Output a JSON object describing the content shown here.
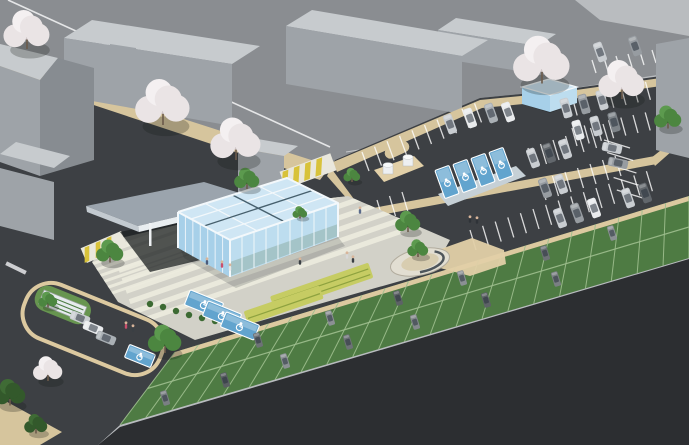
{
  "meta": {
    "subject": "Aerial axonometric architectural rendering of a glass community building with landscaped plaza, surface parking lots, accessible parking stalls, grass-paver parking strip and cherry-blossom street trees",
    "style": "3d-site-visualization"
  },
  "palette": {
    "bg": "#b9bcbf",
    "street": "#8a8d91",
    "whiteLine": "#eef0f1",
    "sidewalk": "#d6c59d",
    "sidewalk2": "#e2d0a8",
    "curb": "#dcc9a0",
    "site": "#3d4044",
    "ground": "#2c2e31",
    "strip": "#4e7b43",
    "stripLine": "#9fbf8f",
    "plaza": "#d2d1c8",
    "plazaStripe": "#ecebde",
    "flower": "#c6cc63",
    "flowerLine": "#8ea23f",
    "hedge": "#3c6a33",
    "blue": "#62a4ce",
    "blueLight": "#9cc8e2",
    "glassTop": "#cfe6f4",
    "glassLeft": "#a7d0e9",
    "glassRight": "#bdddef",
    "glassFrame": "#f3f8fb",
    "glassDark": "#46606e",
    "canopy": "#9ba4ad",
    "canopyEdge": "#e8edf0",
    "canopySide": "#c3cad0",
    "shadow": "#1c2022",
    "bldTop": "#c7cbce",
    "bldFront": "#9ea3a8",
    "bldSide": "#878c91",
    "treeGreen": "#4c8640",
    "treeDark": "#33592b",
    "trunk": "#6b5a4a",
    "blossom": "#eae4e5",
    "blossomShade": "#cfc5c7",
    "humpYellow": "#d8c23a",
    "humpBase": "#e9e7dc"
  },
  "plazaStripes": [
    {
      "x0": 100,
      "y0": 216,
      "px": 3.6,
      "py": 10.4,
      "dx": 0.945,
      "dy": -0.326,
      "len": 360,
      "w": 5.2,
      "n": 11
    },
    {
      "x0": 84,
      "y0": 258,
      "px": 2.3,
      "py": 6.4,
      "dx": 0.945,
      "dy": -0.326,
      "len": 130,
      "w": 3,
      "n": 7
    }
  ],
  "strip": {
    "n": 22,
    "top": [
      175,
      352
    ],
    "topStep": [
      23.36,
      -7.09
    ],
    "bot": [
      120,
      425
    ],
    "botStep": [
      25.86,
      -7.59
    ],
    "mid": [
      [
        147.5,
        388.5
      ],
      [
        689,
        227
      ]
    ]
  },
  "stallLines": [
    {
      "x": 362,
      "y": 152,
      "sx": 12.5,
      "sy": -5.4,
      "n": 10,
      "lx": 7,
      "ly": 19
    },
    {
      "x": 560,
      "y": 100,
      "sx": 12.2,
      "sy": -2.6,
      "n": 9,
      "lx": 5,
      "ly": 18
    },
    {
      "x": 572,
      "y": 128,
      "sx": 12.2,
      "sy": -2.6,
      "n": 8,
      "lx": 5,
      "ly": 18
    },
    {
      "x": 592,
      "y": 60,
      "sx": 12.0,
      "sy": -2.0,
      "n": 8,
      "lx": 4,
      "ly": 13
    },
    {
      "x": 604,
      "y": 140,
      "sx": 3.2,
      "sy": 12.5,
      "n": 5,
      "lx": 26,
      "ly": 8
    },
    {
      "x": 470,
      "y": 230,
      "sx": 12.6,
      "sy": -4.2,
      "n": 15,
      "lx": 6,
      "ly": 20
    },
    {
      "x": 528,
      "y": 148,
      "sx": 12.5,
      "sy": -4.0,
      "n": 7,
      "lx": 6,
      "ly": 20
    },
    {
      "x": 540,
      "y": 180,
      "sx": 12.5,
      "sy": -4.0,
      "n": 7,
      "lx": 6,
      "ly": 20
    },
    {
      "x": 352,
      "y": 208,
      "sx": 12.5,
      "sy": -4.0,
      "n": 5,
      "lx": 6,
      "ly": 20
    },
    {
      "x": 64,
      "y": 310,
      "sx": 11.1,
      "sy": 4.5,
      "n": 6,
      "lx": -9,
      "ly": 22
    },
    {
      "x": 100,
      "y": 344,
      "sx": 5.5,
      "sy": 2.2,
      "n": 9,
      "lx": -6,
      "ly": 14,
      "w": 0.8
    }
  ],
  "blueStalls": [
    {
      "x": 447,
      "y": 182,
      "r": -20,
      "w": 15,
      "h": 30
    },
    {
      "x": 465,
      "y": 176,
      "r": -20,
      "w": 15,
      "h": 30
    },
    {
      "x": 483,
      "y": 170,
      "r": -20,
      "w": 15,
      "h": 30
    },
    {
      "x": 501,
      "y": 164,
      "r": -20,
      "w": 15,
      "h": 30
    },
    {
      "x": 204,
      "y": 304,
      "r": 22,
      "w": 36,
      "h": 16
    },
    {
      "x": 222,
      "y": 315,
      "r": 22,
      "w": 36,
      "h": 16
    },
    {
      "x": 240,
      "y": 326,
      "r": 22,
      "w": 36,
      "h": 16
    },
    {
      "x": 140,
      "y": 356,
      "r": 22,
      "w": 28,
      "h": 14
    }
  ],
  "cars": [
    {
      "x": 450,
      "y": 124,
      "r": 70,
      "c": "#c9cdd1"
    },
    {
      "x": 470,
      "y": 118,
      "r": 70,
      "c": "#e9ebed"
    },
    {
      "x": 491,
      "y": 113,
      "r": 70,
      "c": "#aab0b5"
    },
    {
      "x": 508,
      "y": 112,
      "r": 70,
      "c": "#e9ebed"
    },
    {
      "x": 566,
      "y": 108,
      "r": 74,
      "c": "#c9cdd1"
    },
    {
      "x": 584,
      "y": 104,
      "r": 74,
      "c": "#979ca1"
    },
    {
      "x": 602,
      "y": 100,
      "r": 74,
      "c": "#c9cdd1"
    },
    {
      "x": 578,
      "y": 130,
      "r": 74,
      "c": "#e9ebed"
    },
    {
      "x": 596,
      "y": 126,
      "r": 74,
      "c": "#c9cdd1"
    },
    {
      "x": 614,
      "y": 122,
      "r": 74,
      "c": "#7d8388"
    },
    {
      "x": 600,
      "y": 52,
      "r": 70,
      "c": "#c9cdd1"
    },
    {
      "x": 635,
      "y": 46,
      "r": 70,
      "c": "#979ca1"
    },
    {
      "x": 612,
      "y": 148,
      "r": 12,
      "c": "#c9cdd1"
    },
    {
      "x": 618,
      "y": 163,
      "r": 12,
      "c": "#979ca1"
    },
    {
      "x": 533,
      "y": 158,
      "r": 70,
      "c": "#c9cdd1"
    },
    {
      "x": 549,
      "y": 153,
      "r": 70,
      "c": "#62676c"
    },
    {
      "x": 565,
      "y": 149,
      "r": 70,
      "c": "#c9cdd1"
    },
    {
      "x": 545,
      "y": 188,
      "r": 70,
      "c": "#979ca1"
    },
    {
      "x": 561,
      "y": 184,
      "r": 70,
      "c": "#c9cdd1"
    },
    {
      "x": 560,
      "y": 218,
      "r": 70,
      "c": "#c9cdd1"
    },
    {
      "x": 577,
      "y": 213,
      "r": 70,
      "c": "#979ca1"
    },
    {
      "x": 594,
      "y": 208,
      "r": 70,
      "c": "#e9ebed"
    },
    {
      "x": 628,
      "y": 198,
      "r": 70,
      "c": "#c9cdd1"
    },
    {
      "x": 645,
      "y": 193,
      "r": 70,
      "c": "#62676c"
    },
    {
      "x": 80,
      "y": 318,
      "r": 22,
      "c": "#c9cdd1"
    },
    {
      "x": 93,
      "y": 328,
      "r": 22,
      "c": "#e9ebed"
    },
    {
      "x": 106,
      "y": 338,
      "r": 22,
      "c": "#aab0b5"
    },
    {
      "x": 258,
      "y": 340,
      "r": 73,
      "s": 0.75,
      "c": "#6d7276"
    },
    {
      "x": 330,
      "y": 318,
      "r": 73,
      "s": 0.75,
      "c": "#8b9094"
    },
    {
      "x": 398,
      "y": 298,
      "r": 73,
      "s": 0.75,
      "c": "#5d6266"
    },
    {
      "x": 462,
      "y": 278,
      "r": 73,
      "s": 0.75,
      "c": "#8b9094"
    },
    {
      "x": 545,
      "y": 253,
      "r": 73,
      "s": 0.75,
      "c": "#6d7276"
    },
    {
      "x": 612,
      "y": 233,
      "r": 73,
      "s": 0.75,
      "c": "#8b9094"
    },
    {
      "x": 165,
      "y": 398,
      "r": 73,
      "s": 0.75,
      "c": "#7a7f83"
    },
    {
      "x": 225,
      "y": 380,
      "r": 73,
      "s": 0.75,
      "c": "#595e62"
    },
    {
      "x": 285,
      "y": 361,
      "r": 73,
      "s": 0.75,
      "c": "#8b9094"
    },
    {
      "x": 348,
      "y": 342,
      "r": 73,
      "s": 0.75,
      "c": "#6d7276"
    },
    {
      "x": 415,
      "y": 322,
      "r": 73,
      "s": 0.75,
      "c": "#84898d"
    },
    {
      "x": 486,
      "y": 300,
      "r": 73,
      "s": 0.75,
      "c": "#5d6266"
    },
    {
      "x": 556,
      "y": 279,
      "r": 73,
      "s": 0.75,
      "c": "#7a7f83"
    }
  ],
  "trees": [
    {
      "x": 110,
      "y": 256,
      "r": 13,
      "t": "green"
    },
    {
      "x": 48,
      "y": 303,
      "r": 9,
      "t": "green"
    },
    {
      "x": 165,
      "y": 345,
      "r": 16,
      "t": "green"
    },
    {
      "x": 247,
      "y": 183,
      "r": 12,
      "t": "green"
    },
    {
      "x": 352,
      "y": 178,
      "r": 8,
      "t": "green"
    },
    {
      "x": 408,
      "y": 226,
      "r": 12,
      "t": "green"
    },
    {
      "x": 418,
      "y": 252,
      "r": 10,
      "t": "green"
    },
    {
      "x": 668,
      "y": 122,
      "r": 13,
      "t": "green"
    },
    {
      "x": 300,
      "y": 215,
      "r": 7,
      "t": "green"
    },
    {
      "x": 10,
      "y": 398,
      "r": 15,
      "t": "dark"
    },
    {
      "x": 36,
      "y": 428,
      "r": 11,
      "t": "dark"
    },
    {
      "x": 27,
      "y": 38,
      "r": 22,
      "t": "blossom"
    },
    {
      "x": 163,
      "y": 112,
      "r": 26,
      "t": "blossom"
    },
    {
      "x": 236,
      "y": 148,
      "r": 24,
      "t": "blossom"
    },
    {
      "x": 542,
      "y": 70,
      "r": 27,
      "t": "blossom"
    },
    {
      "x": 622,
      "y": 88,
      "r": 22,
      "t": "blossom"
    },
    {
      "x": 48,
      "y": 374,
      "r": 14,
      "t": "blossom"
    }
  ],
  "people": [
    {
      "x": 222,
      "y": 266,
      "c": "#c94f6d"
    },
    {
      "x": 230,
      "y": 269,
      "c": "#e8e8e8"
    },
    {
      "x": 207,
      "y": 263,
      "c": "#4a5a7a"
    },
    {
      "x": 300,
      "y": 263,
      "c": "#3a3f44"
    },
    {
      "x": 347,
      "y": 257,
      "c": "#d8d8d8"
    },
    {
      "x": 353,
      "y": 261,
      "c": "#3a3f44"
    },
    {
      "x": 470,
      "y": 221,
      "c": "#2f3338"
    },
    {
      "x": 477,
      "y": 222,
      "c": "#2f3338"
    },
    {
      "x": 133,
      "y": 330,
      "c": "#3a3f44"
    },
    {
      "x": 126,
      "y": 327,
      "c": "#c94f6d"
    },
    {
      "x": 360,
      "y": 212,
      "c": "#5a6a8a"
    }
  ],
  "hedges": [
    [
      150,
      304
    ],
    [
      163,
      307
    ],
    [
      176,
      311
    ],
    [
      189,
      315
    ],
    [
      202,
      318
    ],
    [
      215,
      321
    ],
    [
      228,
      324
    ],
    [
      241,
      327
    ]
  ],
  "lerpLines": [
    {
      "a": [
        178,
        212
      ],
      "b": [
        230,
        240
      ],
      "c": [
        178,
        248
      ],
      "d": [
        230,
        277
      ],
      "n": 6,
      "s": "#e9f3f9",
      "w": 1
    },
    {
      "a": [
        230,
        240
      ],
      "b": [
        338,
        203
      ],
      "c": [
        230,
        277
      ],
      "d": [
        338,
        237
      ],
      "n": 8,
      "s": "#eef6fa",
      "w": 1
    },
    {
      "a": [
        178,
        212
      ],
      "b": [
        230,
        240
      ],
      "c": [
        287,
        178
      ],
      "d": [
        338,
        203
      ],
      "n": 3,
      "s": "#f3f8fb",
      "w": 1.2
    },
    {
      "a": [
        178,
        212
      ],
      "b": [
        287,
        178
      ],
      "c": [
        230,
        240
      ],
      "d": [
        338,
        203
      ],
      "n": 3,
      "s": "#f3f8fb",
      "w": 1.2
    },
    {
      "a": [
        178,
        212
      ],
      "b": [
        230,
        240
      ],
      "c": [
        287,
        178
      ],
      "d": [
        338,
        203
      ],
      "n": 1,
      "s": "#46606e",
      "w": 1.4
    },
    {
      "a": [
        178,
        212
      ],
      "b": [
        287,
        178
      ],
      "c": [
        230,
        240
      ],
      "d": [
        338,
        203
      ],
      "n": 1,
      "s": "#46606e",
      "w": 1.4
    }
  ]
}
